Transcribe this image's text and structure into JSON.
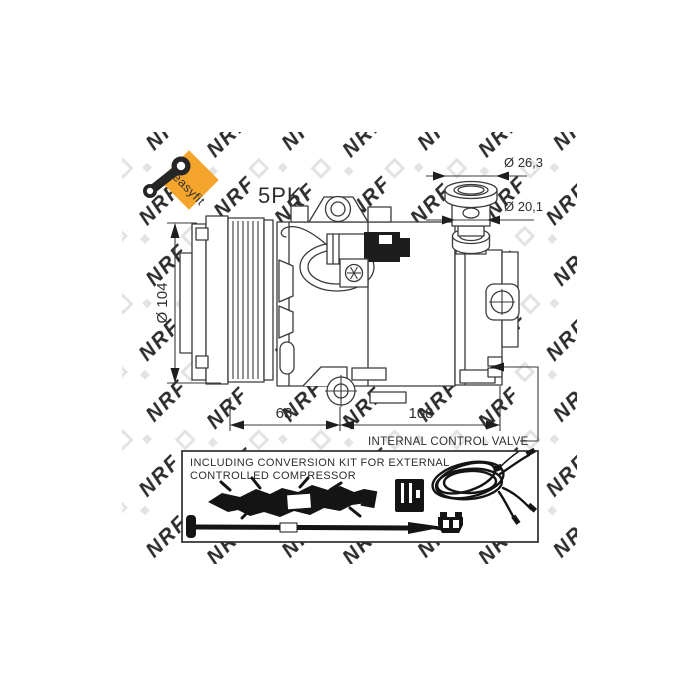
{
  "badge": {
    "label": "easyfit",
    "color": "#f5a42c",
    "icon": "conrod-wrench-icon"
  },
  "drawing": {
    "belt_label": "5PK",
    "dimensions": {
      "pulley_diameter": "Ø 104",
      "port_flange_diameter": "Ø 26,3",
      "port_neck_diameter": "Ø 20,1",
      "length_front": "68",
      "length_rear": "108"
    },
    "callout": "INTERNAL CONTROL VALVE"
  },
  "kit_box": {
    "text_line1": "INCLUDING CONVERSION KIT FOR EXTERNAL",
    "text_line2": "CONTROLLED COMPRESSOR"
  },
  "watermark": {
    "text": "NRF"
  },
  "colors": {
    "line": "#3a3a3a",
    "accent_orange": "#f5a42c",
    "watermark_gray": "#e3e3e3",
    "silhouette_black": "#141414"
  }
}
